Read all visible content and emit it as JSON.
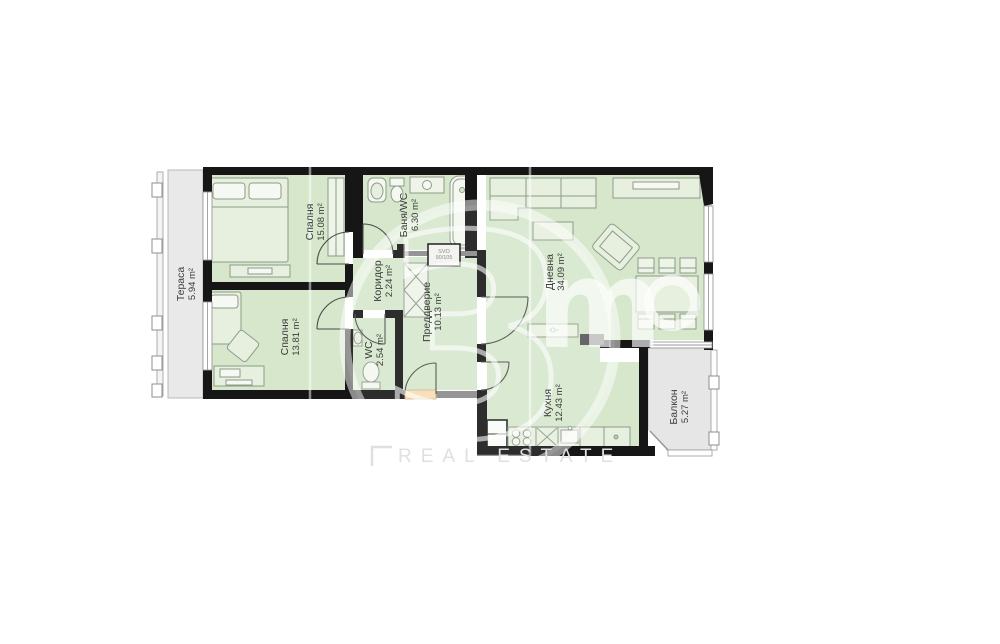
{
  "plan": {
    "rooms": [
      {
        "id": "terrace",
        "name": "Тераса",
        "area": "5.94 m²"
      },
      {
        "id": "bedroom-1",
        "name": "Спалня",
        "area": "15.08 m²"
      },
      {
        "id": "bathroom",
        "name": "Баня/WC",
        "area": "6.30 m²"
      },
      {
        "id": "corridor",
        "name": "Коридор",
        "area": "2.24 m²"
      },
      {
        "id": "bedroom-2",
        "name": "Спалня",
        "area": "13.81 m²"
      },
      {
        "id": "wc",
        "name": "WC",
        "area": "2.54 m²"
      },
      {
        "id": "entry-hall",
        "name": "Преддверие",
        "area": "10.13 m²"
      },
      {
        "id": "living-room",
        "name": "Дневна",
        "area": "34.09 m²"
      },
      {
        "id": "kitchen",
        "name": "Кухня",
        "area": "12.43 m²"
      },
      {
        "id": "balcony",
        "name": "Балкон",
        "area": "5.27 m²"
      }
    ],
    "shaft": {
      "line1": "SVO",
      "line2": "90/105"
    },
    "colors": {
      "room_fill": "#d6e7cc",
      "terrace_fill": "#e9e9e9",
      "wall": "#161616",
      "partition": "#8a8a8a",
      "entrance_marker": "#f6ddb4",
      "furniture_stroke": "#8e9b8a"
    }
  },
  "watermark": {
    "digit": "3",
    "letter_m": "m",
    "letter_o": "o",
    "sub_text": "REAL ESTATE"
  }
}
